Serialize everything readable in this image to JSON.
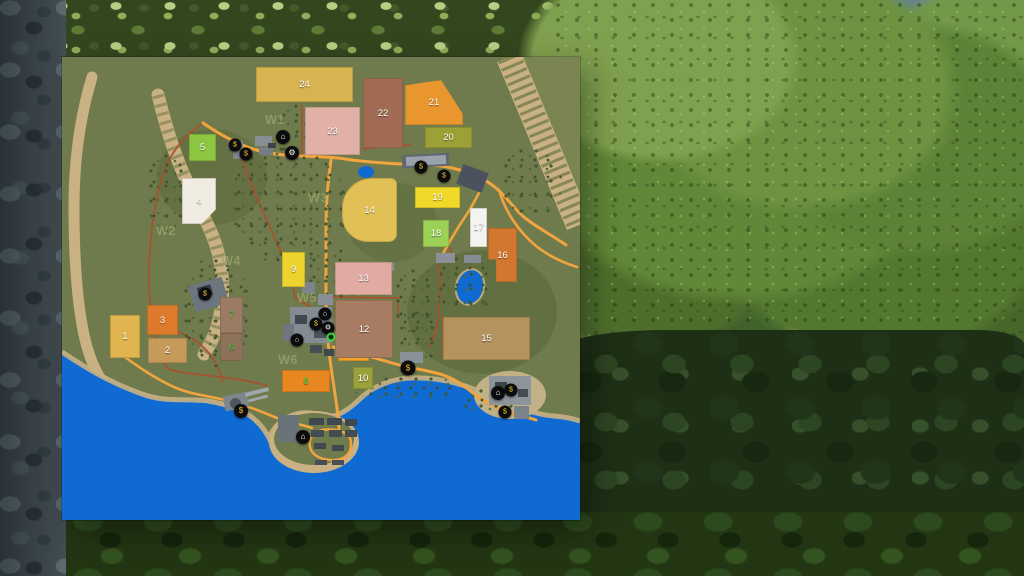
{
  "palette": {
    "terrain": "#6f7b4c",
    "terrain_light": "#7a8551",
    "water": "#0f6ad1",
    "road": "#f2a43e",
    "dirt": "#a8512c",
    "sand": "#c9b183",
    "sand_light": "#d8c79b",
    "forest_dot": "#42552e",
    "waypoint_label": "#97a468",
    "field_green_label": "#3fd63f",
    "marker_bg": "#0c0c0c",
    "marker_yellow": "#f2c437",
    "marker_white": "#ffffff"
  },
  "map": {
    "fields": [
      {
        "n": "1",
        "x": 48,
        "y": 258,
        "w": 30,
        "h": 43,
        "c": "#e0b44e"
      },
      {
        "n": "2",
        "x": 86,
        "y": 281,
        "w": 39,
        "h": 25,
        "c": "#c59a5a"
      },
      {
        "n": "3",
        "x": 85,
        "y": 248,
        "w": 31,
        "h": 30,
        "c": "#de7a2b"
      },
      {
        "n": "4",
        "x": 120,
        "y": 121,
        "w": 34,
        "h": 46,
        "c": "#f1ece2",
        "clip": "polygon(0 0,100% 0,100% 68%,58% 100%,0 100%)"
      },
      {
        "n": "5",
        "x": 127,
        "y": 77,
        "w": 27,
        "h": 27,
        "c": "#8dc741"
      },
      {
        "n": "6",
        "x": 158,
        "y": 276,
        "w": 23,
        "h": 28,
        "c": "#8d7158",
        "t": "#3fd63f"
      },
      {
        "n": "7",
        "x": 158,
        "y": 240,
        "w": 23,
        "h": 36,
        "c": "#9b7b64",
        "t": "#3fd63f"
      },
      {
        "n": "8",
        "x": 220,
        "y": 313,
        "w": 48,
        "h": 22,
        "c": "#e8871f",
        "t": "#3fd63f"
      },
      {
        "n": "9",
        "x": 220,
        "y": 195,
        "w": 23,
        "h": 35,
        "c": "#ecd32e"
      },
      {
        "n": "10",
        "x": 291,
        "y": 310,
        "w": 20,
        "h": 22,
        "c": "#9ba23c"
      },
      {
        "n": "11",
        "x": 276,
        "y": 288,
        "w": 31,
        "h": 16,
        "c": "#f1a226"
      },
      {
        "n": "12",
        "x": 273,
        "y": 243,
        "w": 58,
        "h": 58,
        "c": "#a87b63"
      },
      {
        "n": "13",
        "x": 273,
        "y": 205,
        "w": 57,
        "h": 33,
        "c": "#e1aba3"
      },
      {
        "n": "14",
        "x": 280,
        "y": 121,
        "w": 55,
        "h": 64,
        "c": "#e1c156",
        "r": "30px 6px 8px 26px"
      },
      {
        "n": "15",
        "x": 381,
        "y": 260,
        "w": 87,
        "h": 43,
        "c": "#b5935f"
      },
      {
        "n": "16",
        "x": 426,
        "y": 171,
        "w": 29,
        "h": 54,
        "c": "#d3772e",
        "clip": "polygon(0 0,100% 0,100% 100%,28% 100%,28% 58%,0 58%)"
      },
      {
        "n": "17",
        "x": 408,
        "y": 151,
        "w": 17,
        "h": 39,
        "c": "#f3f3ef"
      },
      {
        "n": "18",
        "x": 361,
        "y": 163,
        "w": 26,
        "h": 27,
        "c": "#9bd157"
      },
      {
        "n": "19",
        "x": 353,
        "y": 130,
        "w": 45,
        "h": 21,
        "c": "#f1d929"
      },
      {
        "n": "20",
        "x": 363,
        "y": 70,
        "w": 47,
        "h": 21,
        "c": "#9ca135"
      },
      {
        "n": "21",
        "x": 343,
        "y": 23,
        "w": 58,
        "h": 45,
        "c": "#ea962f",
        "clip": "polygon(0 12%,62% 0,100% 76%,100% 100%,0 100%)"
      },
      {
        "n": "22",
        "x": 301,
        "y": 21,
        "w": 40,
        "h": 70,
        "c": "#a16c53"
      },
      {
        "n": "23",
        "x": 243,
        "y": 50,
        "w": 55,
        "h": 48,
        "c": "#e1b1a7"
      },
      {
        "n": "24",
        "x": 194,
        "y": 10,
        "w": 97,
        "h": 35,
        "c": "#d7b44f"
      }
    ],
    "waypoints": [
      {
        "n": "W1",
        "x": 213,
        "y": 63
      },
      {
        "n": "W2",
        "x": 104,
        "y": 174
      },
      {
        "n": "W3",
        "x": 256,
        "y": 141
      },
      {
        "n": "W4",
        "x": 169,
        "y": 204
      },
      {
        "n": "W5",
        "x": 245,
        "y": 241
      },
      {
        "n": "W6",
        "x": 226,
        "y": 303
      }
    ],
    "markers": [
      {
        "x": 173,
        "y": 88,
        "s": 13,
        "g": "$",
        "c": "#f2c437",
        "name": "sell-point"
      },
      {
        "x": 184,
        "y": 97,
        "s": 13,
        "g": "$",
        "c": "#f2c437",
        "name": "sell-point"
      },
      {
        "x": 221,
        "y": 80,
        "s": 14,
        "g": "⌂",
        "c": "#ffffff",
        "name": "vehicle-shop"
      },
      {
        "x": 230,
        "y": 96,
        "s": 14,
        "g": "⚙",
        "c": "#ffffff",
        "name": "workshop"
      },
      {
        "x": 359,
        "y": 110,
        "s": 13,
        "g": "$",
        "c": "#f2c437",
        "name": "sell-point"
      },
      {
        "x": 382,
        "y": 119,
        "s": 13,
        "g": "$",
        "c": "#f2c437",
        "name": "sell-point"
      },
      {
        "x": 143,
        "y": 237,
        "s": 13,
        "g": "$",
        "c": "#f2c437",
        "name": "sell-point"
      },
      {
        "x": 263,
        "y": 257,
        "s": 13,
        "g": "⌂",
        "c": "#ffffff",
        "name": "shop"
      },
      {
        "x": 254,
        "y": 267,
        "s": 13,
        "g": "$",
        "c": "#f2c437",
        "name": "sell-point"
      },
      {
        "x": 266,
        "y": 271,
        "s": 13,
        "g": "⚙",
        "c": "#ffffff",
        "name": "workshop"
      },
      {
        "x": 235,
        "y": 283,
        "s": 13,
        "g": "⌂",
        "c": "#ffffff",
        "name": "vehicle-dealer"
      },
      {
        "x": 346,
        "y": 311,
        "s": 15,
        "g": "$",
        "c": "#f2c437",
        "name": "sell-point"
      },
      {
        "x": 436,
        "y": 336,
        "s": 14,
        "g": "⌂",
        "c": "#ffffff",
        "name": "animal-dealer"
      },
      {
        "x": 449,
        "y": 333,
        "s": 13,
        "g": "$",
        "c": "#f2c437",
        "name": "sell-point"
      },
      {
        "x": 443,
        "y": 355,
        "s": 13,
        "g": "$",
        "c": "#f2c437",
        "name": "sell-point"
      },
      {
        "x": 179,
        "y": 354,
        "s": 14,
        "g": "$",
        "c": "#f2c437",
        "name": "sell-point"
      },
      {
        "x": 241,
        "y": 380,
        "s": 14,
        "g": "⌂",
        "c": "#ffffff",
        "name": "port"
      },
      {
        "x": 269,
        "y": 280,
        "player": true,
        "name": "player-marker"
      }
    ],
    "buildings": [
      {
        "x": 166,
        "y": 84,
        "w": 15,
        "h": 8,
        "c": "#8a9096"
      },
      {
        "x": 171,
        "y": 93,
        "w": 16,
        "h": 9,
        "c": "#7d848b"
      },
      {
        "x": 193,
        "y": 79,
        "w": 17,
        "h": 10,
        "c": "#878e95"
      },
      {
        "x": 197,
        "y": 90,
        "w": 14,
        "h": 8,
        "c": "#747c84"
      },
      {
        "x": 206,
        "y": 86,
        "w": 8,
        "h": 5,
        "c": "#3c434a"
      },
      {
        "x": 340,
        "y": 97,
        "w": 47,
        "h": 13,
        "c": "#5f6771",
        "r": -3
      },
      {
        "x": 344,
        "y": 99,
        "w": 40,
        "h": 9,
        "c": "#9aa2ac",
        "r": -3
      },
      {
        "x": 397,
        "y": 111,
        "w": 27,
        "h": 21,
        "c": "#49525d",
        "r": 20
      },
      {
        "x": 374,
        "y": 196,
        "w": 19,
        "h": 10,
        "c": "#8a9098"
      },
      {
        "x": 402,
        "y": 198,
        "w": 17,
        "h": 8,
        "c": "#858c94"
      },
      {
        "x": 129,
        "y": 224,
        "w": 35,
        "h": 27,
        "c": "#6d757f",
        "r": -16
      },
      {
        "x": 136,
        "y": 229,
        "w": 14,
        "h": 11,
        "c": "#323a45",
        "r": -16
      },
      {
        "x": 228,
        "y": 250,
        "w": 42,
        "h": 36,
        "c": "#848b93"
      },
      {
        "x": 240,
        "y": 225,
        "w": 13,
        "h": 11,
        "c": "#7c848c"
      },
      {
        "x": 256,
        "y": 237,
        "w": 15,
        "h": 11,
        "c": "#888f97"
      },
      {
        "x": 221,
        "y": 267,
        "w": 11,
        "h": 17,
        "c": "#6e767e"
      },
      {
        "x": 233,
        "y": 258,
        "w": 12,
        "h": 9,
        "c": "#3f474f"
      },
      {
        "x": 252,
        "y": 272,
        "w": 14,
        "h": 9,
        "c": "#4a525a"
      },
      {
        "x": 276,
        "y": 252,
        "w": 10,
        "h": 8,
        "c": "#7b838b"
      },
      {
        "x": 276,
        "y": 264,
        "w": 10,
        "h": 8,
        "c": "#6f777f"
      },
      {
        "x": 248,
        "y": 288,
        "w": 12,
        "h": 8,
        "c": "#454d55"
      },
      {
        "x": 262,
        "y": 292,
        "w": 10,
        "h": 7,
        "c": "#3f474f"
      },
      {
        "x": 315,
        "y": 206,
        "w": 17,
        "h": 8,
        "c": "#878e96"
      },
      {
        "x": 338,
        "y": 295,
        "w": 23,
        "h": 11,
        "c": "#8a9199"
      },
      {
        "x": 162,
        "y": 337,
        "w": 24,
        "h": 15,
        "c": "#7d858d",
        "r": -12
      },
      {
        "x": 183,
        "y": 333,
        "w": 24,
        "h": 4,
        "c": "#9fa7ae",
        "r": -14
      },
      {
        "x": 186,
        "y": 340,
        "w": 20,
        "h": 3,
        "c": "#9fa7ae",
        "r": -14
      },
      {
        "x": 168,
        "y": 341,
        "w": 11,
        "h": 11,
        "c": "#4d555d",
        "rd": 1
      },
      {
        "x": 427,
        "y": 319,
        "w": 42,
        "h": 29,
        "c": "#8d949c"
      },
      {
        "x": 452,
        "y": 349,
        "w": 15,
        "h": 13,
        "c": "#7a828a"
      },
      {
        "x": 433,
        "y": 325,
        "w": 12,
        "h": 9,
        "c": "#3c434b"
      },
      {
        "x": 456,
        "y": 332,
        "w": 10,
        "h": 8,
        "c": "#444c54"
      },
      {
        "x": 216,
        "y": 358,
        "w": 21,
        "h": 27,
        "c": "#6a727a"
      },
      {
        "x": 247,
        "y": 361,
        "w": 15,
        "h": 7,
        "c": "#40484f"
      },
      {
        "x": 265,
        "y": 361,
        "w": 15,
        "h": 7,
        "c": "#40484f"
      },
      {
        "x": 283,
        "y": 362,
        "w": 12,
        "h": 7,
        "c": "#40484f"
      },
      {
        "x": 249,
        "y": 373,
        "w": 13,
        "h": 7,
        "c": "#444c53"
      },
      {
        "x": 267,
        "y": 373,
        "w": 13,
        "h": 7,
        "c": "#444c53"
      },
      {
        "x": 283,
        "y": 373,
        "w": 12,
        "h": 7,
        "c": "#444c53"
      },
      {
        "x": 252,
        "y": 386,
        "w": 12,
        "h": 6,
        "c": "#40484f"
      },
      {
        "x": 270,
        "y": 388,
        "w": 12,
        "h": 6,
        "c": "#40484f"
      },
      {
        "x": 253,
        "y": 403,
        "w": 12,
        "h": 5,
        "c": "#474f56"
      },
      {
        "x": 270,
        "y": 403,
        "w": 12,
        "h": 5,
        "c": "#474f56"
      }
    ]
  }
}
